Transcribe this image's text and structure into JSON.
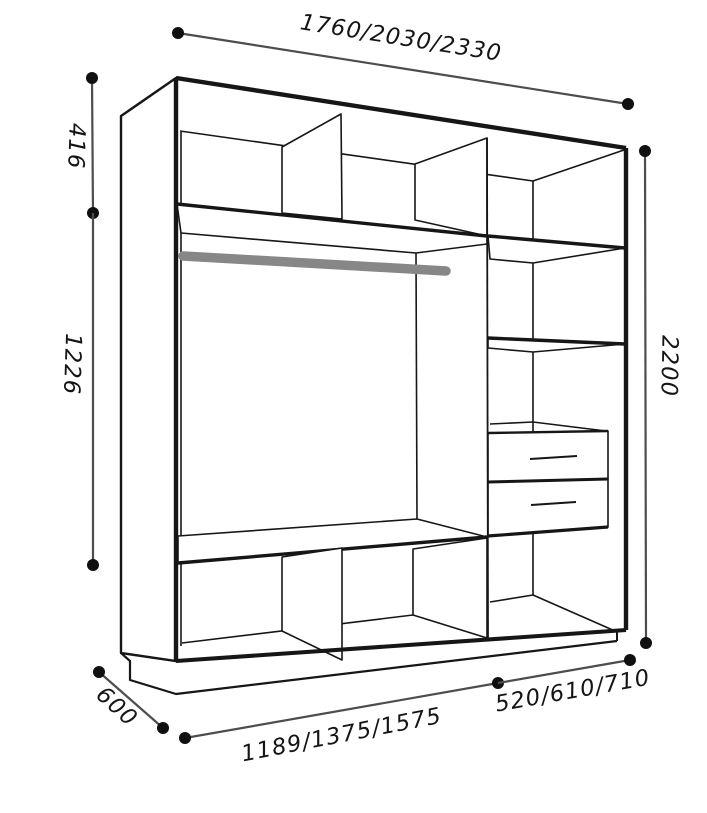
{
  "diagram": {
    "subject": "wardrobe interior carcass dimension drawing",
    "dims": {
      "width": "1760/2030/2330",
      "upper_section_height": "416",
      "hanging_section_height": "1226",
      "total_height": "2200",
      "depth": "600",
      "left_section_width": "1189/1375/1575",
      "right_section_width": "520/610/710"
    },
    "colors": {
      "line": "#161616",
      "dimension_line": "#4d4d4d",
      "dot": "#101010",
      "rail": "#878787",
      "background": "#ffffff"
    }
  }
}
